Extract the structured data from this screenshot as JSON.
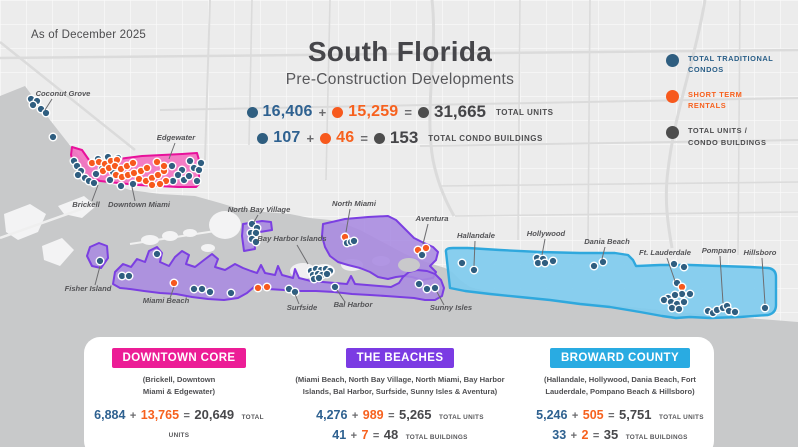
{
  "meta": {
    "as_of": "As of December 2025"
  },
  "title": {
    "main": "South Florida",
    "subtitle": "Pre-Construction Developments"
  },
  "ops": {
    "plus": "+",
    "equals": "="
  },
  "colors": {
    "blue": "#2F5E80",
    "orange": "#F7591D",
    "dark": "#4D4D4D"
  },
  "stats": {
    "rows": [
      {
        "a": "16,406",
        "b": "15,259",
        "total": "31,665",
        "label": "TOTAL UNITS"
      },
      {
        "a": "107",
        "b": "46",
        "total": "153",
        "label": "TOTAL CONDO BUILDINGS"
      }
    ]
  },
  "legend": {
    "items": [
      {
        "line1": "TOTAL TRADITIONAL",
        "line2": "CONDOS",
        "color": "#2A5F88",
        "dot": "#2F5E80"
      },
      {
        "line1": "SHORT TERM",
        "line2": "RENTALS",
        "color": "#F7611E",
        "dot": "#F7591D"
      },
      {
        "line1": "TOTAL UNITS /",
        "line2": "CONDO BUILDINGS",
        "color": "#4D4D4F",
        "dot": "#4D4D4D"
      }
    ]
  },
  "cards": [
    {
      "name": "DOWNTOWN CORE",
      "color": "#EC1D96",
      "sub1": "(Brickell, Downtown",
      "sub2": "Miami & Edgewater)",
      "units": {
        "a": "6,884",
        "b": "13,765",
        "total": "20,649",
        "label": "TOTAL UNITS"
      },
      "buildings": {
        "a": "33",
        "b": "37",
        "total": "70",
        "label": "TOTAL BUILDINGS"
      }
    },
    {
      "name": "THE BEACHES",
      "color": "#7B3BE3",
      "sub1": "(Miami Beach, North Bay Village, North Miami, Bay Harbor",
      "sub2": "Islands, Bal Harbor, Surfside, Sunny Isles & Aventura)",
      "units": {
        "a": "4,276",
        "b": "989",
        "total": "5,265",
        "label": "TOTAL UNITS"
      },
      "buildings": {
        "a": "41",
        "b": "7",
        "total": "48",
        "label": "TOTAL BUILDINGS"
      }
    },
    {
      "name": "BROWARD COUNTY",
      "color": "#29ABE2",
      "sub1": "(Hallandale, Hollywood, Dania Beach, Fort",
      "sub2": "Lauderdale, Pompano Beach & Hillsboro)",
      "units": {
        "a": "5,246",
        "b": "505",
        "total": "5,751",
        "label": "TOTAL UNITS"
      },
      "buildings": {
        "a": "33",
        "b": "2",
        "total": "35",
        "label": "TOTAL BUILDINGS"
      }
    }
  ],
  "map": {
    "labels": [
      {
        "text": "Coconut Grove",
        "x": 63,
        "y": 96,
        "line": [
          52,
          99,
          45,
          110
        ]
      },
      {
        "text": "Edgewater",
        "x": 176,
        "y": 140,
        "line": [
          175,
          143,
          169,
          159
        ]
      },
      {
        "text": "Brickell",
        "x": 86,
        "y": 207,
        "line": [
          92,
          201,
          98,
          185
        ]
      },
      {
        "text": "Downtown Miami",
        "x": 139,
        "y": 207,
        "line": [
          135,
          201,
          132,
          187
        ]
      },
      {
        "text": "Fisher Island",
        "x": 88,
        "y": 291,
        "line": [
          95,
          285,
          100,
          266
        ]
      },
      {
        "text": "Miami Beach",
        "x": 166,
        "y": 303,
        "line": [
          170,
          298,
          174,
          287
        ]
      },
      {
        "text": "North Bay Village",
        "x": 259,
        "y": 212,
        "line": [
          258,
          215,
          254,
          222
        ]
      },
      {
        "text": "Bay Harbor Islands",
        "x": 292,
        "y": 241,
        "line": [
          297,
          245,
          308,
          264
        ]
      },
      {
        "text": "North Miami",
        "x": 354,
        "y": 206,
        "line": [
          350,
          209,
          346,
          232
        ]
      },
      {
        "text": "Aventura",
        "x": 432,
        "y": 221,
        "line": [
          428,
          224,
          423,
          244
        ]
      },
      {
        "text": "Hallandale",
        "x": 476,
        "y": 238,
        "line": [
          475,
          241,
          474,
          266
        ]
      },
      {
        "text": "Hollywood",
        "x": 546,
        "y": 236,
        "line": [
          545,
          239,
          542,
          255
        ]
      },
      {
        "text": "Dania Beach",
        "x": 607,
        "y": 244,
        "line": [
          605,
          247,
          602,
          259
        ]
      },
      {
        "text": "Ft. Lauderdale",
        "x": 665,
        "y": 255,
        "line": [
          667,
          258,
          675,
          281
        ]
      },
      {
        "text": "Pompano",
        "x": 719,
        "y": 253,
        "line": [
          720,
          256,
          723,
          303
        ]
      },
      {
        "text": "Hillsboro",
        "x": 760,
        "y": 255,
        "line": [
          762,
          258,
          765,
          304
        ]
      },
      {
        "text": "Surfside",
        "x": 302,
        "y": 310,
        "line": [
          299,
          304,
          295,
          294
        ]
      },
      {
        "text": "Bal Harbor",
        "x": 353,
        "y": 307,
        "line": [
          345,
          302,
          337,
          290
        ]
      },
      {
        "text": "Sunny Isles",
        "x": 451,
        "y": 310,
        "line": [
          444,
          305,
          437,
          292
        ]
      }
    ],
    "dots": [
      [
        31,
        99,
        "b"
      ],
      [
        37,
        101,
        "b"
      ],
      [
        33,
        105,
        "b"
      ],
      [
        41,
        109,
        "b"
      ],
      [
        46,
        113,
        "b"
      ],
      [
        53,
        137,
        "b"
      ],
      [
        74,
        161,
        "b"
      ],
      [
        77,
        166,
        "b"
      ],
      [
        81,
        171,
        "b"
      ],
      [
        78,
        175,
        "b"
      ],
      [
        85,
        178,
        "b"
      ],
      [
        89,
        181,
        "b"
      ],
      [
        94,
        183,
        "b"
      ],
      [
        98,
        159,
        "b"
      ],
      [
        108,
        157,
        "b"
      ],
      [
        118,
        158,
        "b"
      ],
      [
        102,
        169,
        "b"
      ],
      [
        96,
        174,
        "b"
      ],
      [
        113,
        172,
        "b"
      ],
      [
        110,
        180,
        "b"
      ],
      [
        121,
        186,
        "b"
      ],
      [
        133,
        184,
        "b"
      ],
      [
        172,
        166,
        "b"
      ],
      [
        182,
        170,
        "b"
      ],
      [
        178,
        175,
        "b"
      ],
      [
        184,
        180,
        "b"
      ],
      [
        173,
        181,
        "b"
      ],
      [
        189,
        176,
        "b"
      ],
      [
        194,
        168,
        "b"
      ],
      [
        190,
        161,
        "b"
      ],
      [
        197,
        181,
        "b"
      ],
      [
        199,
        170,
        "b"
      ],
      [
        201,
        163,
        "b"
      ],
      [
        92,
        163,
        "o"
      ],
      [
        99,
        162,
        "o"
      ],
      [
        105,
        164,
        "o"
      ],
      [
        111,
        161,
        "o"
      ],
      [
        117,
        160,
        "o"
      ],
      [
        103,
        171,
        "o"
      ],
      [
        109,
        168,
        "o"
      ],
      [
        115,
        166,
        "o"
      ],
      [
        121,
        169,
        "o"
      ],
      [
        127,
        166,
        "o"
      ],
      [
        133,
        163,
        "o"
      ],
      [
        116,
        175,
        "o"
      ],
      [
        122,
        177,
        "o"
      ],
      [
        128,
        175,
        "o"
      ],
      [
        134,
        173,
        "o"
      ],
      [
        141,
        171,
        "o"
      ],
      [
        147,
        168,
        "o"
      ],
      [
        139,
        179,
        "o"
      ],
      [
        146,
        181,
        "o"
      ],
      [
        152,
        178,
        "o"
      ],
      [
        158,
        175,
        "o"
      ],
      [
        164,
        171,
        "o"
      ],
      [
        157,
        162,
        "o"
      ],
      [
        164,
        166,
        "o"
      ],
      [
        166,
        181,
        "o"
      ],
      [
        152,
        185,
        "o"
      ],
      [
        160,
        184,
        "o"
      ],
      [
        100,
        261,
        "b"
      ],
      [
        122,
        276,
        "b"
      ],
      [
        129,
        276,
        "b"
      ],
      [
        157,
        254,
        "b"
      ],
      [
        174,
        283,
        "o"
      ],
      [
        194,
        289,
        "b"
      ],
      [
        202,
        289,
        "b"
      ],
      [
        210,
        292,
        "b"
      ],
      [
        231,
        293,
        "b"
      ],
      [
        258,
        288,
        "o"
      ],
      [
        267,
        287,
        "o"
      ],
      [
        289,
        289,
        "b"
      ],
      [
        295,
        292,
        "b"
      ],
      [
        252,
        224,
        "b"
      ],
      [
        257,
        228,
        "b"
      ],
      [
        251,
        233,
        "b"
      ],
      [
        256,
        233,
        "b"
      ],
      [
        252,
        239,
        "b"
      ],
      [
        256,
        242,
        "b"
      ],
      [
        311,
        271,
        "b"
      ],
      [
        316,
        269,
        "b"
      ],
      [
        321,
        270,
        "b"
      ],
      [
        326,
        269,
        "b"
      ],
      [
        330,
        271,
        "b"
      ],
      [
        313,
        275,
        "b"
      ],
      [
        318,
        274,
        "b"
      ],
      [
        322,
        275,
        "b"
      ],
      [
        327,
        274,
        "b"
      ],
      [
        314,
        279,
        "b"
      ],
      [
        319,
        278,
        "b"
      ],
      [
        335,
        287,
        "b"
      ],
      [
        345,
        237,
        "o"
      ],
      [
        347,
        243,
        "b"
      ],
      [
        351,
        242,
        "b"
      ],
      [
        354,
        241,
        "b"
      ],
      [
        418,
        250,
        "o"
      ],
      [
        426,
        248,
        "o"
      ],
      [
        422,
        255,
        "b"
      ],
      [
        419,
        284,
        "b"
      ],
      [
        427,
        289,
        "b"
      ],
      [
        435,
        288,
        "b"
      ],
      [
        462,
        263,
        "b"
      ],
      [
        474,
        270,
        "b"
      ],
      [
        537,
        258,
        "b"
      ],
      [
        543,
        259,
        "b"
      ],
      [
        538,
        263,
        "b"
      ],
      [
        545,
        263,
        "b"
      ],
      [
        553,
        261,
        "b"
      ],
      [
        594,
        266,
        "b"
      ],
      [
        603,
        262,
        "b"
      ],
      [
        674,
        264,
        "b"
      ],
      [
        684,
        267,
        "b"
      ],
      [
        677,
        283,
        "b"
      ],
      [
        682,
        287,
        "o"
      ],
      [
        682,
        294,
        "b"
      ],
      [
        690,
        294,
        "b"
      ],
      [
        675,
        295,
        "b"
      ],
      [
        668,
        298,
        "b"
      ],
      [
        664,
        300,
        "b"
      ],
      [
        671,
        302,
        "b"
      ],
      [
        677,
        304,
        "b"
      ],
      [
        684,
        302,
        "b"
      ],
      [
        672,
        308,
        "b"
      ],
      [
        679,
        309,
        "b"
      ],
      [
        708,
        311,
        "b"
      ],
      [
        713,
        313,
        "b"
      ],
      [
        717,
        310,
        "b"
      ],
      [
        723,
        308,
        "b"
      ],
      [
        727,
        306,
        "b"
      ],
      [
        729,
        311,
        "b"
      ],
      [
        735,
        312,
        "b"
      ],
      [
        765,
        308,
        "b"
      ]
    ]
  }
}
